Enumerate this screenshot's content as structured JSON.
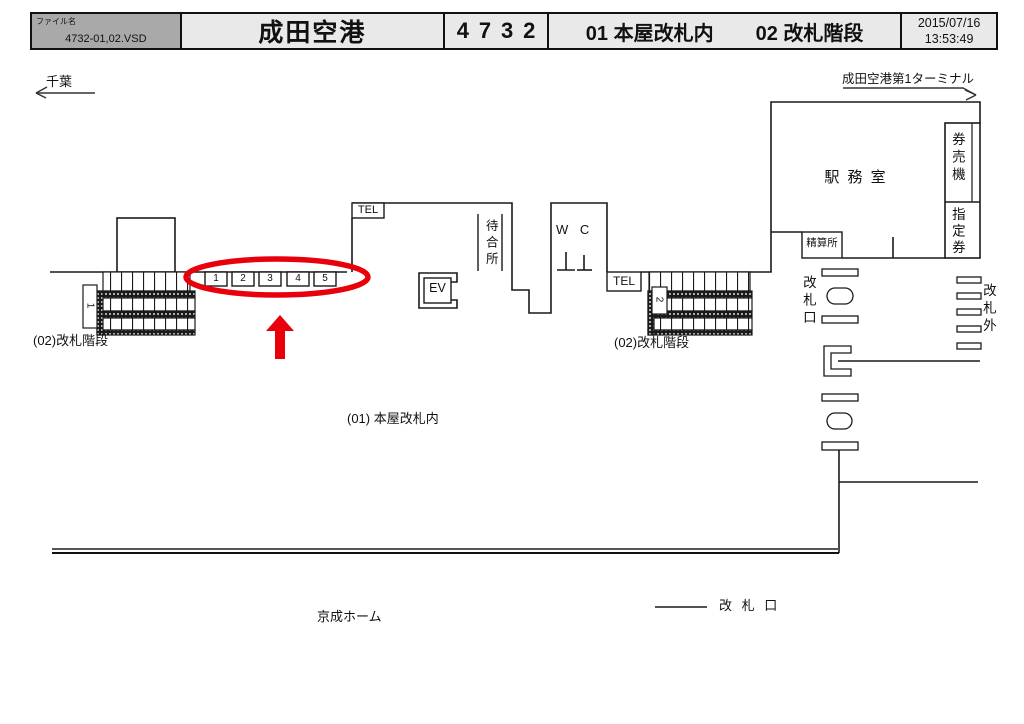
{
  "header": {
    "file_label": "ファイル名",
    "file_name": "4732-01,02.VSD",
    "station": "成田空港",
    "number": "4732",
    "section1": "01 本屋改札内",
    "section2": "02 改札階段",
    "date": "2015/07/16",
    "time": "13:53:49"
  },
  "directions": {
    "left": "千葉",
    "right": "成田空港第1ターミナル"
  },
  "rooms": {
    "office": "駅 務 室",
    "ticket_machines": "券売機",
    "reserved": "指定券",
    "fare_adjust": "精算所",
    "waiting": "待合所",
    "wc": "W C",
    "tel_left": "TEL",
    "tel_right": "TEL",
    "elevator": "EV"
  },
  "gate": {
    "label": "改札口",
    "outside": "改札外"
  },
  "stairs": {
    "left_label": "(02)改札階段",
    "right_label": "(02)改札階段",
    "left_no": "1",
    "right_no": "2"
  },
  "labels": {
    "concourse": "(01) 本屋改札内",
    "platform": "京成ホーム",
    "legend_gate": "改 札 口"
  },
  "platform_numbers": [
    "1",
    "2",
    "3",
    "4",
    "5"
  ],
  "annotation": {
    "color": "#e8000b"
  }
}
